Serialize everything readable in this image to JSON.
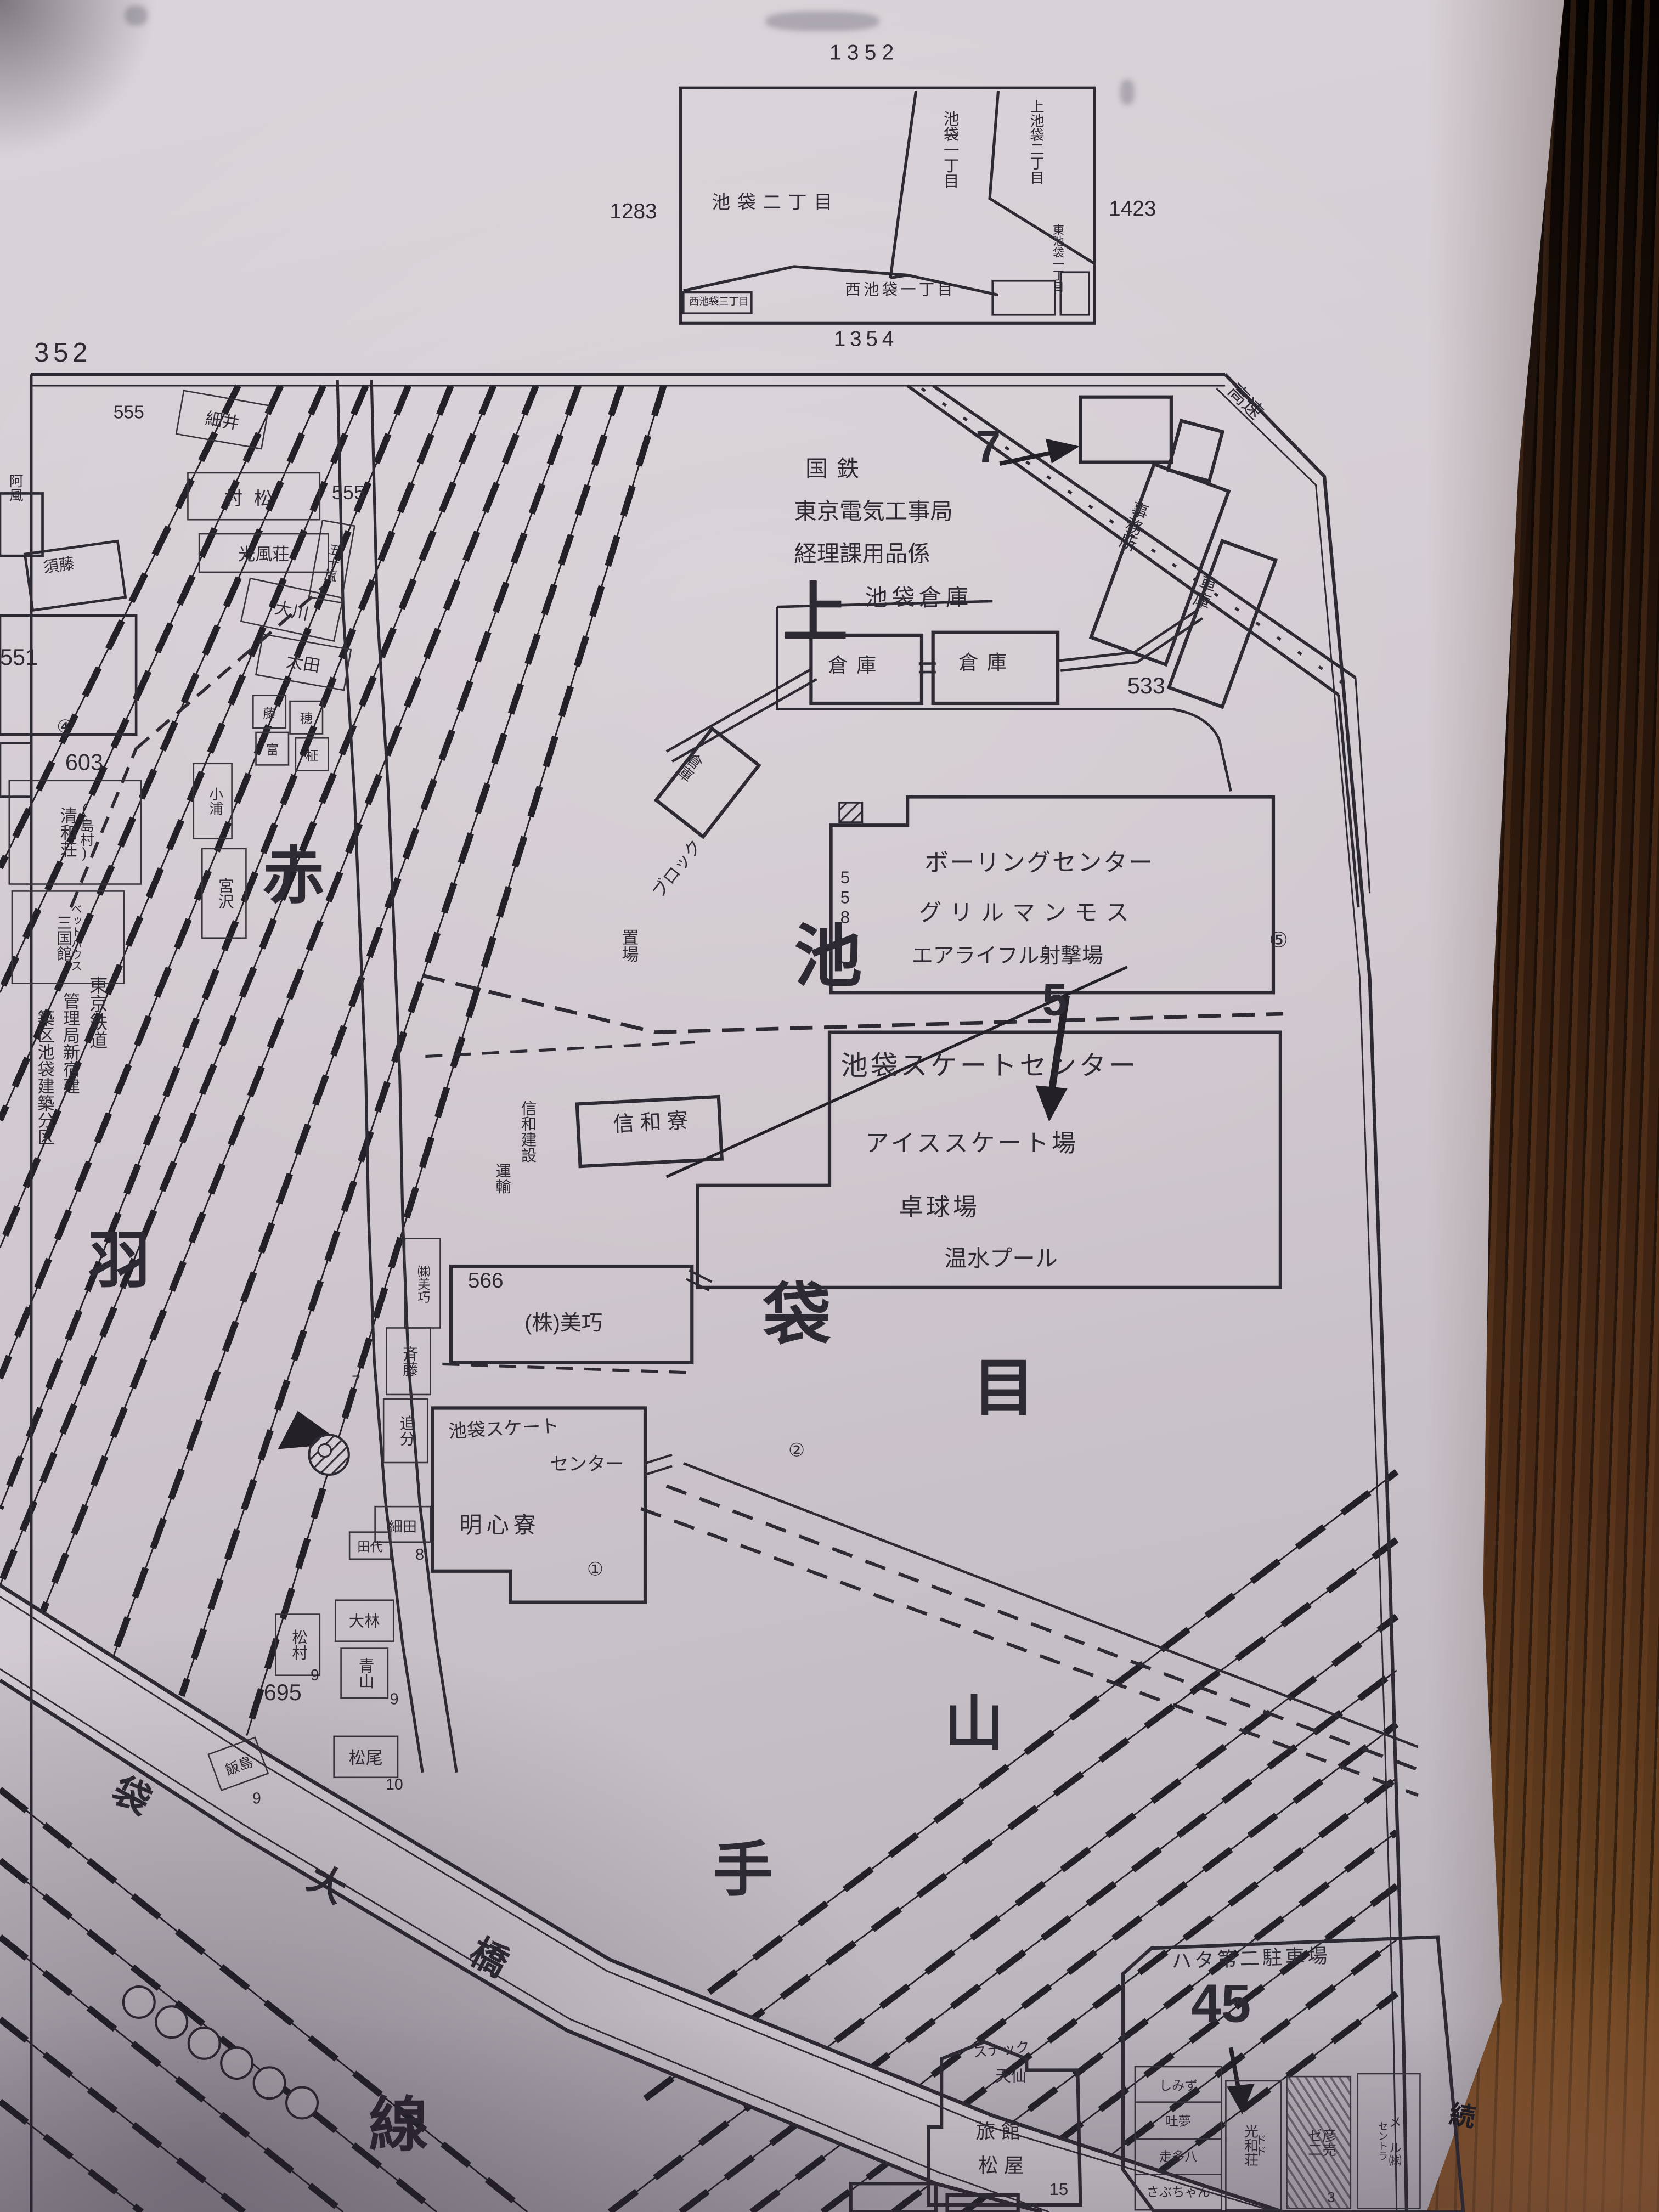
{
  "photo": {
    "surface": "wood-table",
    "edge_note": "続"
  },
  "inset": {
    "num_top": "1352",
    "num_left": "1283",
    "num_right": "1423",
    "num_bottom": "1354",
    "area_ike2": "池袋二丁目",
    "area_ike1": "池袋一丁目",
    "area_kami2": "上池袋二丁目",
    "area_higashi1": "東池袋一丁目",
    "area_nishi1": "西池袋一丁目",
    "area_nishi3": "西池袋三丁目"
  },
  "sheet": {
    "corner_number": "352"
  },
  "big": {
    "kami": "上",
    "ike": "池",
    "fukuro": "袋",
    "me": "目",
    "aka": "赤",
    "hane": "羽",
    "yama": "山",
    "te": "手",
    "sen": "線",
    "road1": "袋",
    "road2": "大",
    "road3": "橋"
  },
  "labels": {
    "kokutetsu": "国鉄",
    "koujikyoku": "東京電気工事局",
    "keirika": "経理課用品係",
    "soko_title": "池袋倉庫",
    "marker7": "7",
    "souko_a": "倉庫",
    "souko_b": "倉庫",
    "souko_c": "倉庫",
    "jimusho": "事務所",
    "shako": "車庫",
    "kosoku": "高速",
    "n533": "533",
    "n558": "558",
    "n566": "566",
    "n695": "695",
    "n551": "551",
    "n603": "603",
    "n555a": "555",
    "n555b": "555",
    "maru1": "①",
    "maru2": "②",
    "maru4": "④",
    "maru5": "⑤",
    "block_a": "ブロック",
    "block_b": "置場",
    "bowling": "ボーリングセンター",
    "grill": "グリルマンモス",
    "rifle": "エアライフル射撃場",
    "skate": "池袋スケートセンター",
    "marker5": "5",
    "ice": "アイススケート場",
    "pingpong": "卓球場",
    "pool": "温水プール",
    "shinwa_kensetsu": "信和建設",
    "shinwa_unyu": "運輸",
    "shinwa_ryo": "信和寮",
    "biko": "(株)美巧",
    "biko_v": "㈱美巧",
    "meishin_a": "池袋スケート",
    "meishin_b": "センター",
    "meishin": "明心寮",
    "tetsudo1": "東京鉄道",
    "tetsudo2": "管理局新宿建",
    "tetsudo3": "築区池袋建築分区",
    "hosoi": "細井",
    "muramatsu": "村松",
    "kofuso": "光風荘",
    "okawa": "大川",
    "ota": "太田",
    "igarashi": "五十嵐",
    "sudo": "須藤",
    "afu": "阿風",
    "seiwa": "清和荘",
    "shimamura": "(島村)",
    "sangoku": "三国館",
    "bed": "ベットハウス",
    "koura": "小浦",
    "miyazawa": "宮沢",
    "tiny1": "藤",
    "tiny2": "穂",
    "tiny3": "富",
    "tiny4": "柾",
    "saito": "斉藤",
    "oiwake": "追分",
    "hosoda": "細田",
    "tashiro": "田代",
    "obayashi": "大林",
    "aoyama": "青山",
    "matsumura": "松村",
    "matsuo": "松尾",
    "iijima": "飯島",
    "h7": "7",
    "h8": "8",
    "h9a": "9",
    "h9b": "9",
    "h9c": "9",
    "h10": "10",
    "h15": "15",
    "h3": "3",
    "hata": "ハタ第二駐車場",
    "n45": "45",
    "shimizu": "しみず",
    "tomu": "吐夢",
    "sota": "走多八",
    "sabu": "さぶちゃん",
    "kowa": "光和荘",
    "dd": "ドド",
    "zeni": "ゼ二",
    "hiko": "彦売",
    "centr": "セントラ",
    "mail": "メール㈱",
    "snack": "スナック",
    "tensen": "天仙",
    "ryokan": "旅館",
    "matsuya": "松屋",
    "tsuzuki": "続"
  }
}
